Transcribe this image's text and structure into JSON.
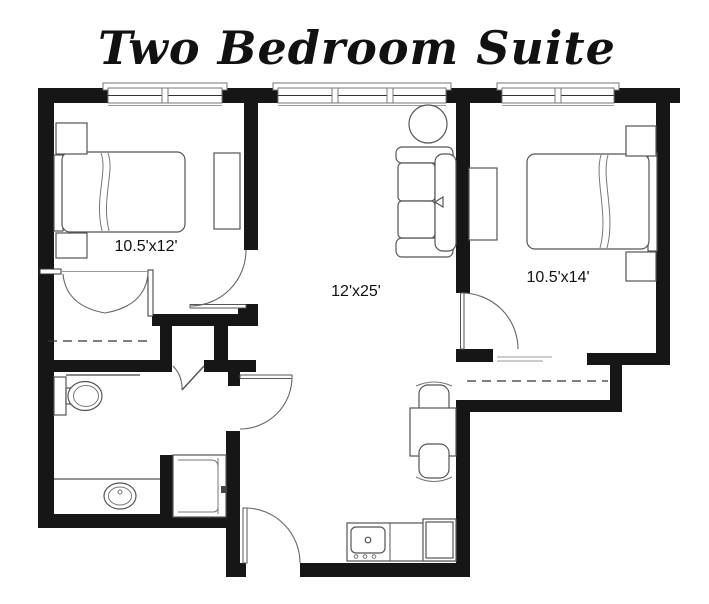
{
  "title": "Two Bedroom Suite",
  "rooms": {
    "bedroom1": {
      "dimensions": "10.5'x12'"
    },
    "living": {
      "dimensions": "12'x25'"
    },
    "bedroom2": {
      "dimensions": "10.5'x14'"
    }
  },
  "colors": {
    "walls": "#161616",
    "background": "#ffffff",
    "label_text": "#111111",
    "furniture_line": "#555555"
  }
}
